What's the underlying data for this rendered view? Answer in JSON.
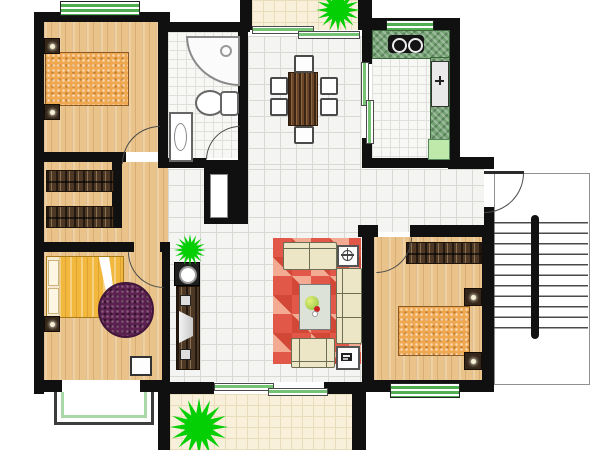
{
  "document": {
    "kind": "residential apartment floor plan, top-down colour render",
    "width_px": 600,
    "height_px": 450,
    "background": "#ffffff",
    "visible_text": "none (no legible labels or dimensions in the image)"
  },
  "palette": {
    "wall_black": "#101010",
    "wood_floor_tan": "#e9c389",
    "hall_tile_white": "#f4f4f2",
    "balcony_tile_beige": "#f8f0da",
    "plant_green": "#04cf04",
    "window_frame_green": "#4fae4f",
    "kitchen_counter_green": "#77a377",
    "fridge_light_green": "#bfe8ab",
    "living_rug_red": "#e25848",
    "bedroom_rug_purple": "#5c2150",
    "bed_gold": "#f2b83e",
    "bed_speckle_orange": "#efa850",
    "furniture_brown": "#4d3826",
    "sofa_cream": "#ece5c6"
  },
  "symbols": [
    {
      "name": "plant-starburst-icon",
      "count": 3,
      "color": "#04cf04"
    },
    {
      "name": "stove-burner-icon",
      "count": 2
    },
    {
      "name": "faucet-icon",
      "count": 1
    },
    {
      "name": "flower-pot-icon",
      "count": 1
    },
    {
      "name": "tv-icon",
      "count": 1
    },
    {
      "name": "washing-machine-icon",
      "count": 1
    },
    {
      "name": "door-swing-arc-icon",
      "count": 5
    }
  ],
  "rooms": {
    "bedroom_top_left": {
      "fixtures": [
        "double-bed (speckled mattress)",
        "nightstand",
        "nightstand",
        "green striped window (top)"
      ]
    },
    "dressing_area_left": {
      "fixtures": [
        "wardrobe",
        "wardrobe"
      ]
    },
    "bathroom": {
      "fixtures": [
        "corner-shower",
        "toilet",
        "washbasin",
        "door swing"
      ]
    },
    "dining_area": {
      "fixtures": [
        "wooden dining table",
        "6 chairs"
      ]
    },
    "kitchen": {
      "fixtures": [
        "green counter L",
        "2-burner stove",
        "sink",
        "fridge (light green)",
        "green striped window",
        "sliding door to dining"
      ]
    },
    "balcony_top": {
      "fixtures": [
        "plant starburst",
        "sliding window to dining"
      ]
    },
    "hallway_center": {
      "fixtures": [
        "washing-machine",
        "tv-cabinet with tv and speakers",
        "plant starburst",
        "duct shaft niche"
      ]
    },
    "living_room": {
      "fixtures": [
        "red patchwork rug",
        "3-seat sofa (right)",
        "loveseat (top)",
        "armchair (bottom)",
        "coffee-table with plant",
        "side-table with flower",
        "side-table with device",
        "sliding door to balcony"
      ]
    },
    "bedroom_bottom_left": {
      "fixtures": [
        "gold double-bed with white sheet and pillows",
        "purple round rug",
        "nightstand",
        "stool",
        "bay window (bottom)"
      ]
    },
    "bedroom_bottom_right": {
      "fixtures": [
        "wardrobe",
        "double-bed (speckled mattress)",
        "nightstand",
        "nightstand",
        "green striped window (bottom)",
        "door swing"
      ]
    },
    "staircase_right": {
      "fixtures": [
        "stair treads",
        "central handrail",
        "entrance door swing"
      ]
    },
    "balcony_bottom": {
      "fixtures": [
        "large plant starburst"
      ]
    }
  }
}
